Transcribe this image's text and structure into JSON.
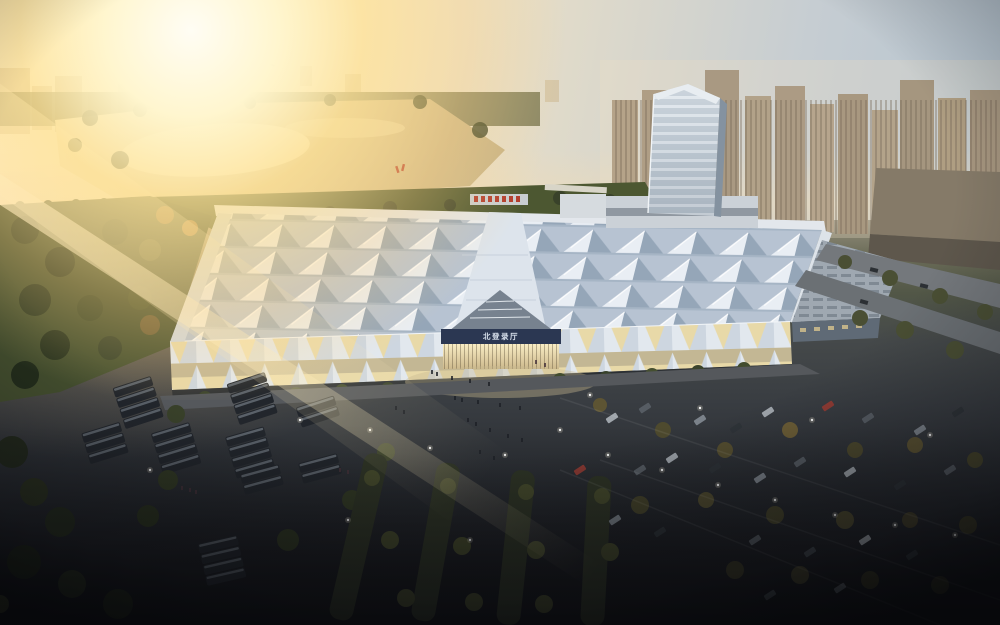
{
  "scene": {
    "title": "Aerial architectural rendering of an exhibition center at sunset",
    "time_of_day": "sunset",
    "description": "Large convention hall with a grid of pyramidal roof modules, glass tower at the rear, lakeside park and sun glare upper-left, dense city skyline upper-right, bus depot lower-left and tree-lined car parking lower-right, lit plaza with visitors at the main entrance"
  },
  "building": {
    "entrance_sign_text": "北登录厅",
    "entrance_sign_bg": "#2b3752",
    "entrance_sign_text_color": "#d8e0ec",
    "rear_sign_color": "#b13a2c",
    "roof_base": "#b7c3d2",
    "roof_highlight": "#e9eef4",
    "roof_shadow": "#95a6b8",
    "facade_glass_glow": "#f0e0a8",
    "tower_glass": "#b9c4cf"
  },
  "environment": {
    "sun_glow": "#fff6cf",
    "sky_top_right": "#b4c3cf",
    "lake": "#e2cf9e",
    "park_green": "#4c5731",
    "asphalt": "#3a3e43",
    "skyline_haze": "#d8c9ae",
    "bus_color": "#22262c",
    "tree_dark": "#2c331f",
    "tree_warm": "#8a6a38"
  }
}
